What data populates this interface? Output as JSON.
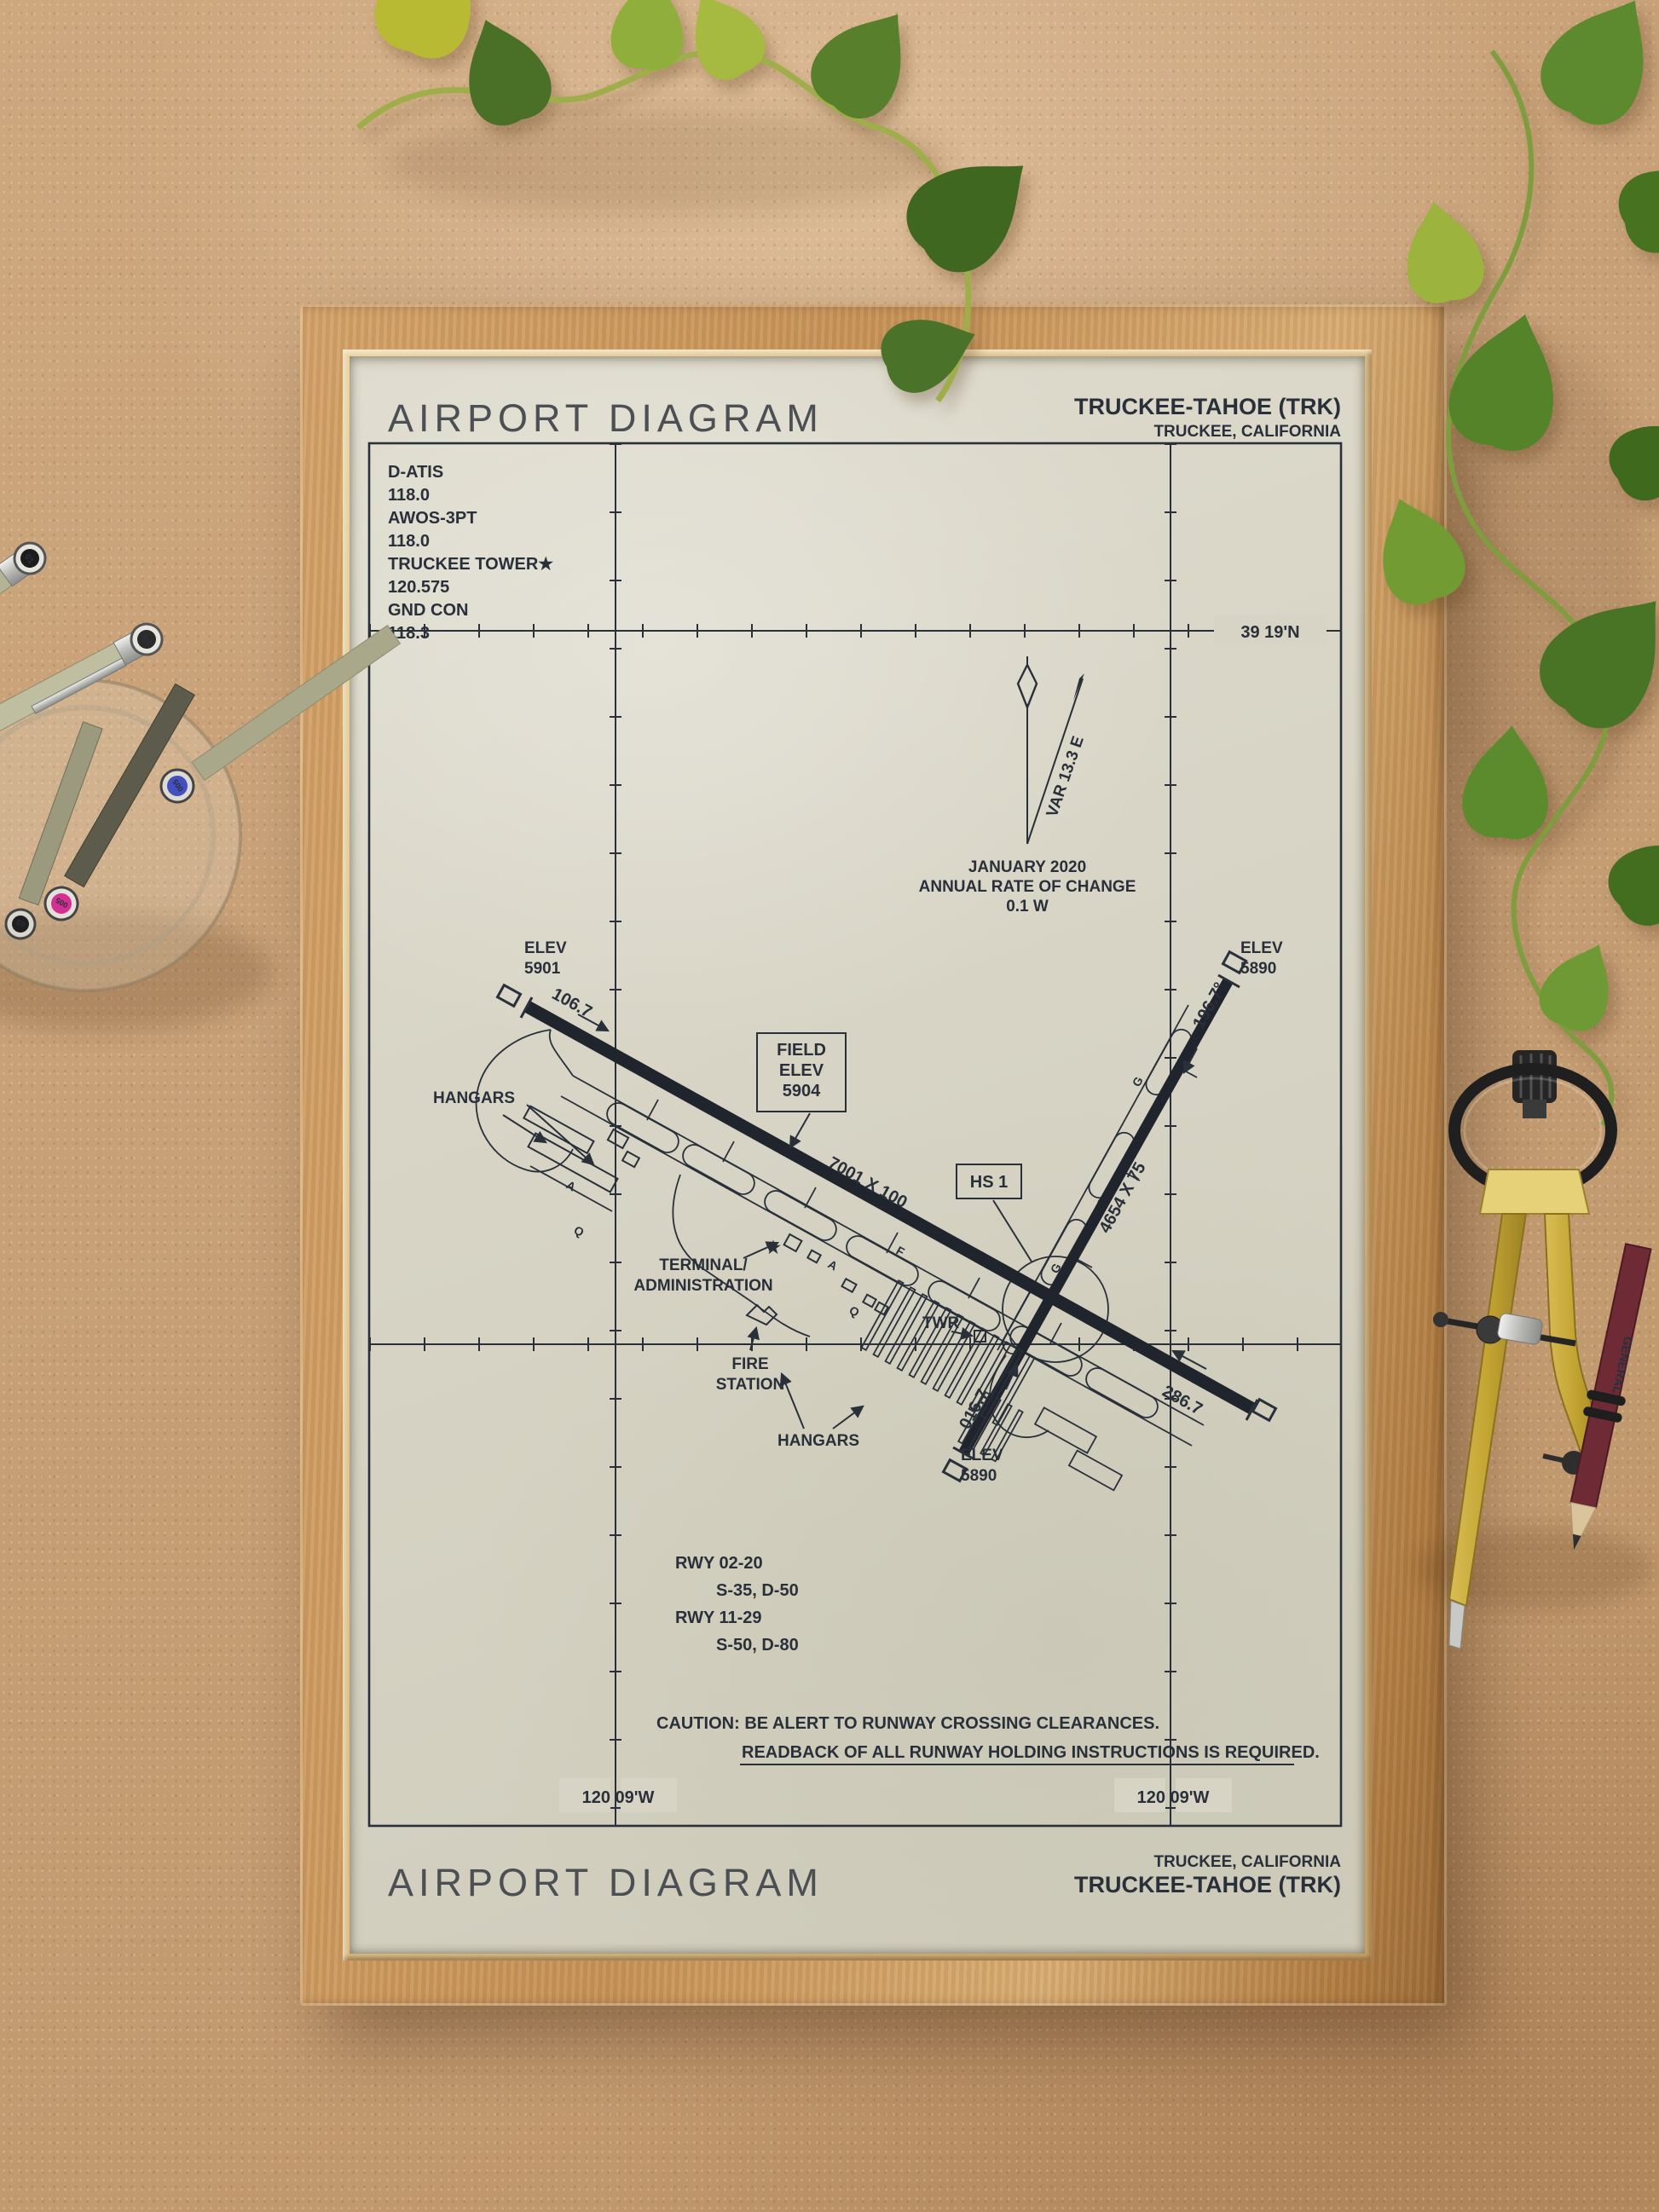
{
  "poster": {
    "header": {
      "title": "AIRPORT DIAGRAM",
      "airport": "TRUCKEE-TAHOE (TRK)",
      "city": "TRUCKEE, CALIFORNIA"
    },
    "footer": {
      "title": "AIRPORT DIAGRAM",
      "city": "TRUCKEE, CALIFORNIA",
      "airport": "TRUCKEE-TAHOE (TRK)"
    },
    "comms": [
      {
        "label": "D-ATIS",
        "freq": "118.0"
      },
      {
        "label": "AWOS-3PT",
        "freq": "118.0"
      },
      {
        "label": "TRUCKEE TOWER★",
        "freq": "120.575"
      },
      {
        "label": "GND CON",
        "freq": "118.3"
      }
    ],
    "graticule": {
      "lat": "39 19'N",
      "lon_left": "120 09'W",
      "lon_right": "120 09'W"
    },
    "variation": {
      "var": "VAR 13.3 E",
      "date": "JANUARY 2020",
      "note": "ANNUAL RATE OF CHANGE",
      "rate": "0.1  W"
    },
    "diagram": {
      "labels": {
        "elev11_1": "ELEV",
        "elev11_2": "5901",
        "elev20_1": "ELEV",
        "elev20_2": "5890",
        "elev02_1": "ELEV",
        "elev02_2": "5890",
        "hdg11": "106.7",
        "hdg29": "286.7",
        "hdg20": "196.7°",
        "hdg02": "016.7",
        "dim1129": "7001 X 100",
        "dim0220": "4654 X 75",
        "field1": "FIELD",
        "field2": "ELEV",
        "field3": "5904",
        "hs1": "HS 1",
        "hangars_nw": "HANGARS",
        "hangars_s": "HANGARS",
        "terminal1": "TERMINAL/",
        "terminal2": "ADMINISTRATION",
        "twr": "TWR",
        "fire1": "FIRE",
        "fire2": "STATION",
        "txy_a": "A",
        "txy_q": "Q",
        "txy_f": "F",
        "txy_g": "G"
      },
      "rwy_data": [
        {
          "rwy": "RWY 02-20",
          "codes": "S-35, D-50"
        },
        {
          "rwy": "RWY 11-29",
          "codes": "S-50, D-80"
        }
      ],
      "caution1": "CAUTION: BE ALERT TO RUNWAY CROSSING CLEARANCES.",
      "caution2": "READBACK OF ALL RUNWAY HOLDING INSTRUCTIONS IS REQUIRED."
    }
  },
  "scene": {
    "pens": {
      "brand": "MICRON 005",
      "cap_labels": [
        "01",
        "005",
        "005",
        "03"
      ]
    },
    "pencil": {
      "brand": "GENERAL"
    }
  }
}
